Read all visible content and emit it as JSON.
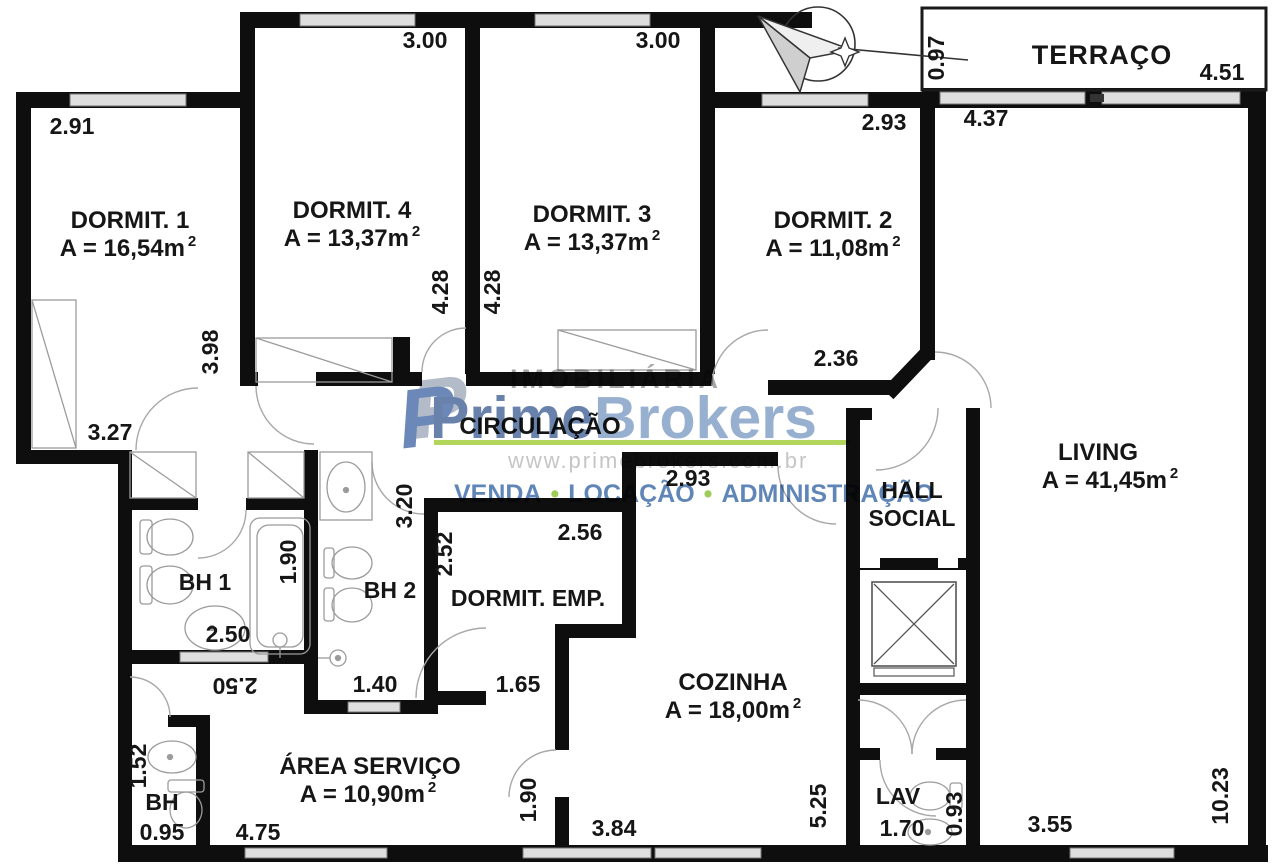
{
  "plan": {
    "rooms": {
      "dormit1": {
        "name": "DORMIT. 1",
        "area": "A = 16,54m",
        "sup": "2"
      },
      "dormit4": {
        "name": "DORMIT. 4",
        "area": "A = 13,37m",
        "sup": "2"
      },
      "dormit3": {
        "name": "DORMIT. 3",
        "area": "A = 13,37m",
        "sup": "2"
      },
      "dormit2": {
        "name": "DORMIT. 2",
        "area": "A = 11,08m",
        "sup": "2"
      },
      "terraco": {
        "name": "TERRAÇO"
      },
      "living": {
        "name": "LIVING",
        "area": "A = 41,45m",
        "sup": "2"
      },
      "circulacao": {
        "name": "CIRCULAÇÃO"
      },
      "hall": {
        "name": "HALL",
        "name2": "SOCIAL"
      },
      "bh1": {
        "name": "BH 1"
      },
      "bh2": {
        "name": "BH 2"
      },
      "dormitemp": {
        "name": "DORMIT. EMP."
      },
      "cozinha": {
        "name": "COZINHA",
        "area": "A = 18,00m",
        "sup": "2"
      },
      "areaservico": {
        "name": "ÁREA SERVIÇO",
        "area": "A = 10,90m",
        "sup": "2"
      },
      "bh": {
        "name": "BH"
      },
      "lav": {
        "name": "LAV"
      }
    },
    "dims": [
      {
        "v": "2.91"
      },
      {
        "v": "3.00"
      },
      {
        "v": "3.00"
      },
      {
        "v": "2.93"
      },
      {
        "v": "0.97"
      },
      {
        "v": "4.51"
      },
      {
        "v": "4.37"
      },
      {
        "v": "3.98"
      },
      {
        "v": "4.28"
      },
      {
        "v": "4.28"
      },
      {
        "v": "2.36"
      },
      {
        "v": "3.27"
      },
      {
        "v": "2.93"
      },
      {
        "v": "3.20"
      },
      {
        "v": "1.90"
      },
      {
        "v": "2.52"
      },
      {
        "v": "2.56"
      },
      {
        "v": "2.50"
      },
      {
        "v": "2.50"
      },
      {
        "v": "1.40"
      },
      {
        "v": "1.65"
      },
      {
        "v": "1.52"
      },
      {
        "v": "0.95"
      },
      {
        "v": "4.75"
      },
      {
        "v": "1.90"
      },
      {
        "v": "3.84"
      },
      {
        "v": "5.25"
      },
      {
        "v": "1.70"
      },
      {
        "v": "0.93"
      },
      {
        "v": "3.55"
      },
      {
        "v": "10.23"
      }
    ]
  },
  "watermark": {
    "icon": "P",
    "brand_top": "IMOBILIÁRIA",
    "brand_main": "Prime",
    "brand_main2": "Brokers",
    "website": "www.primebrokers.com.br",
    "services": [
      "VENDA",
      "LOCAÇÃO",
      "ADMINISTRAÇÃO"
    ],
    "bullet": "•",
    "colors": {
      "prime_blue": "#54719f",
      "brokers_blue": "#8aa5ca",
      "green": "#a8cf45",
      "services_blue": "#4a74ad",
      "gray": "#9b9b9b"
    }
  }
}
